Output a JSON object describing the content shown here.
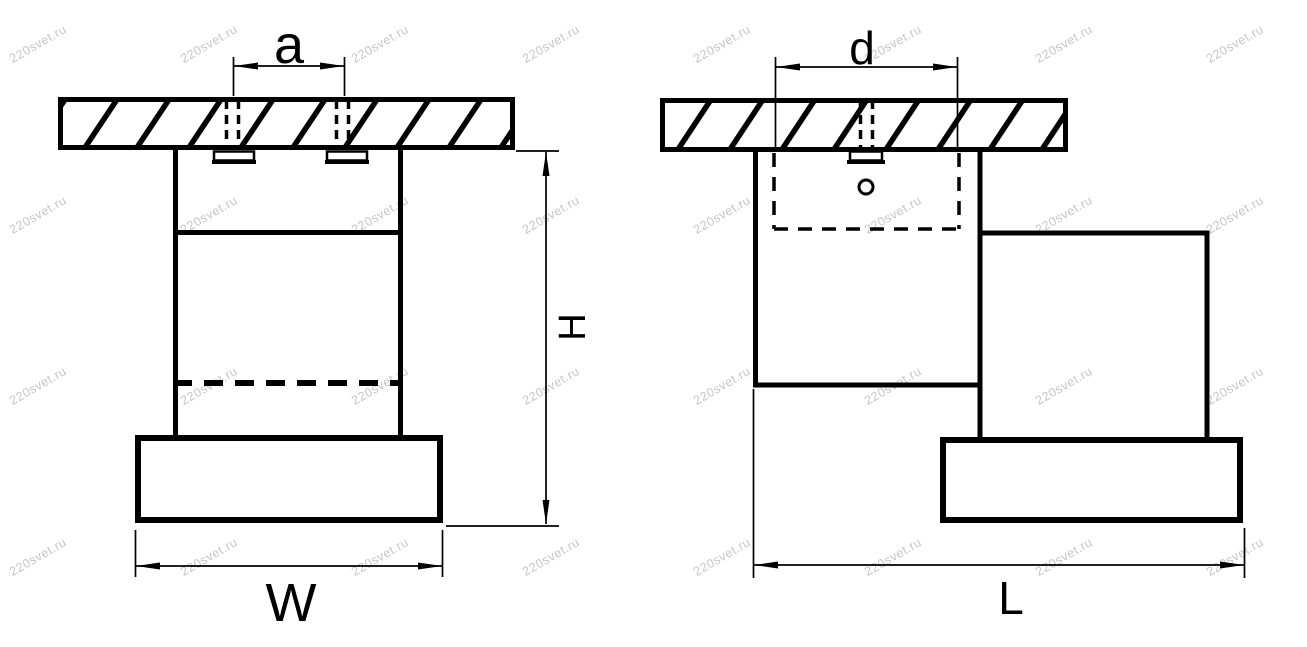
{
  "document": {
    "background": "#ffffff",
    "ink": "#000000"
  },
  "watermark": {
    "text": "220svet.ru",
    "color": "#c6c6c6"
  },
  "views": {
    "front": {
      "labels": {
        "mount_spacing": "a",
        "height": "H",
        "width": "W"
      }
    },
    "side": {
      "labels": {
        "mount_spacing": "d",
        "length": "L"
      }
    }
  }
}
